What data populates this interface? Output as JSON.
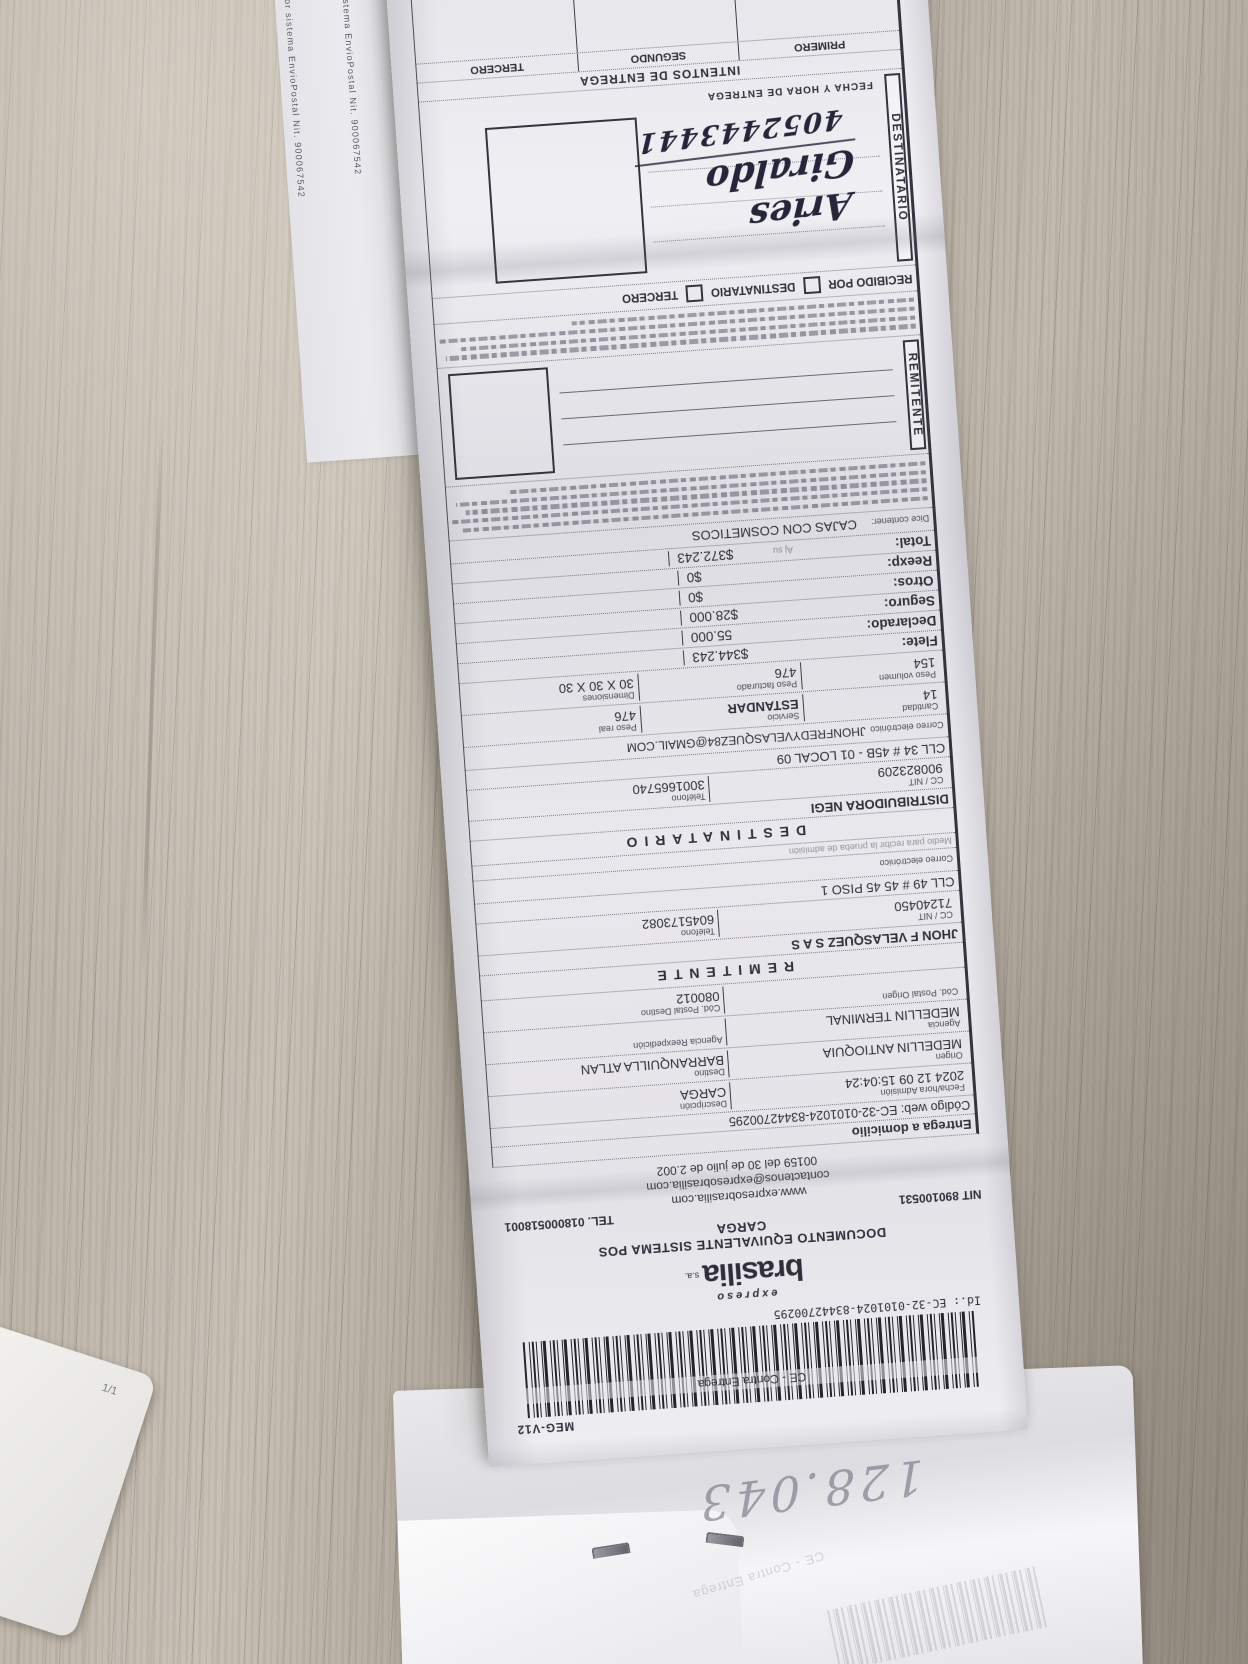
{
  "side_sheet": {
    "line1": "por sistema EnvioPostal Nit. 900067542",
    "line2": "Sistema EnvioPostal Nit. 900067542"
  },
  "receipt": {
    "top": {
      "meg_code": "MEG-V12",
      "contra_label": "CE - Contra Entrega",
      "id_line": "Id.: EC-32-0101024-83442700295"
    },
    "brand": {
      "expreso": "expreso",
      "name": "brasilia",
      "sa": "s.a."
    },
    "doc_title": "DOCUMENTO EQUIVALENTE SISTEMA POS",
    "doc_subtitle": "CARGA",
    "nit": "NIT 890100531",
    "tel": "TEL. 018000518001",
    "web": "www.expresobrasilia.com",
    "contact_email": "contactenos@expresobrasilia.com",
    "resolution": "00159 del 30 de julio de 2.002",
    "entrega": "Entrega a domicilio",
    "codigo_web": "Código web: EC-32-0101024-83442700295",
    "admission": {
      "label": "Fecha/hora Admisión",
      "value": "2024 12 09 15:04:24",
      "desc_label": "Descripción",
      "desc_value": "CARGA"
    },
    "route": {
      "origin_label": "Origen",
      "origin": "MEDELLIN ANTIOQUIA",
      "dest_label": "Destino",
      "dest": "BARRANQUILLA ATLAN"
    },
    "agency": {
      "label": "Agencia",
      "value": "MEDELLIN TERMINAL",
      "reexp_label": "Agencia Reexpedición",
      "reexp_value": ""
    },
    "postal": {
      "origin_label": "Cód. Postal Origen",
      "origin_value": "",
      "dest_label": "Cód. Postal Destino",
      "dest_value": "080012"
    },
    "sender": {
      "title": "REMITENTE",
      "name": "JHON F VELASQUEZ S A S",
      "nit_label": "CC / NIT",
      "nit": "71240450",
      "phone_label": "Teléfono",
      "phone": "6045173082",
      "address": "CLL 49 # 45 45 PISO 1",
      "email_label": "Correo electrónico",
      "email": "",
      "medio": "Medio para recibir la prueba de admisión"
    },
    "recipient": {
      "title": "DESTINATARIO",
      "name": "DISTRIBUIDORA NEGI",
      "nit_label": "CC / NIT",
      "nit": "900823209",
      "phone_label": "Teléfono",
      "phone": "3001665740",
      "address": "CLL 34 # 45B - 01 LOCAL 09",
      "email_label": "Correo electrónico",
      "email": "JHONFREDYVELASQUEZ84@GMAIL.COM"
    },
    "parcel": {
      "cantidad_label": "Cantidad",
      "cantidad": "14",
      "servicio_label": "Servicio",
      "servicio": "ESTANDAR",
      "peso_real_label": "Peso real",
      "peso_real": "476",
      "peso_vol_label": "Peso volumen",
      "peso_vol": "154",
      "peso_fact_label": "Peso facturado",
      "peso_fact": "476",
      "dim_label": "Dimensiones",
      "dim": "30 X 30 X 30"
    },
    "charges": {
      "flete_label": "Flete:",
      "flete": "$344.243",
      "declarado_label": "Declarado:",
      "declarado": "55.000",
      "seguro_label": "Seguro:",
      "seguro": "$28.000",
      "otros_label": "Otros:",
      "otros": "$0",
      "reexp_label": "Reexp:",
      "reexp": "$0",
      "total_label": "Total:",
      "total": "$372.243",
      "total_note": "Aj  su"
    },
    "contents": {
      "label": "Dice contener:",
      "value": "CAJAS CON COSMETICOS"
    },
    "signature": {
      "tab": "REMITENTE"
    },
    "received": {
      "label": "RECIBIDO POR",
      "opt1": "DESTINATARIO",
      "opt2": "TERCERO",
      "tab": "DESTINATARIO",
      "hand_name": "Aries Giraldo",
      "hand_number": "4052443441",
      "fecha_label": "FECHA Y HORA DE ENTREGA"
    },
    "attempts": {
      "title": "INTENTOS DE ENTREGA",
      "c1": "PRIMERO",
      "c2": "SEGUNDO",
      "c3": "TERCERO"
    }
  },
  "under_paper": {
    "pencil": "128.043",
    "ghost": "CE - Contra Entrega"
  },
  "page_card": {
    "label": "1/1"
  }
}
